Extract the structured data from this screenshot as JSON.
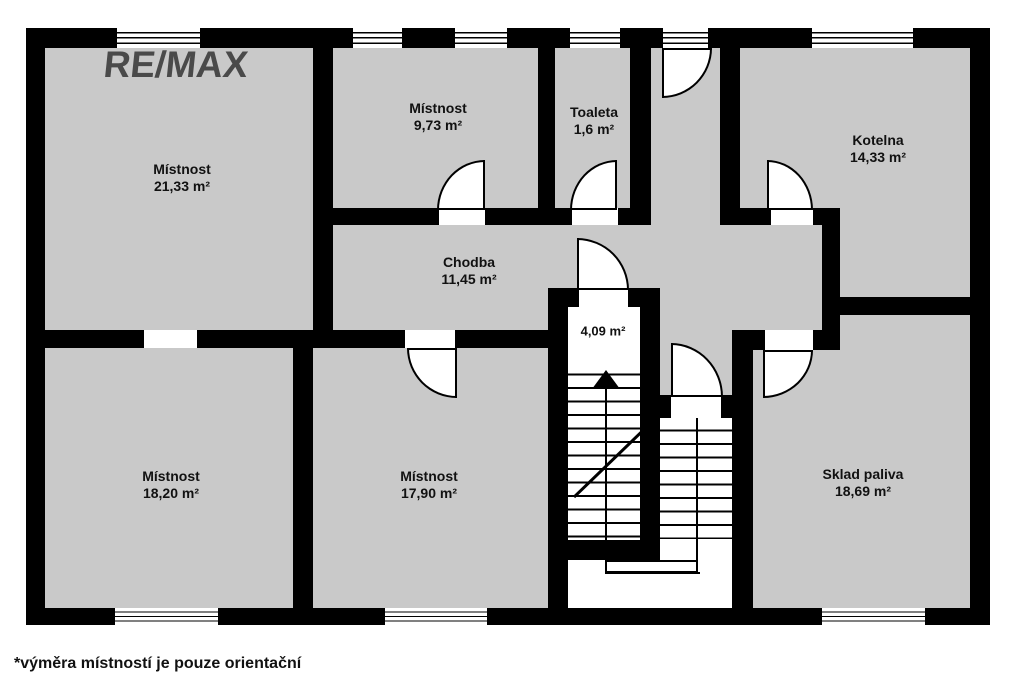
{
  "logo": {
    "text": "RE/MAX"
  },
  "rooms": [
    {
      "name": "Místnost",
      "area": "21,33 m²"
    },
    {
      "name": "Místnost",
      "area": "9,73 m²"
    },
    {
      "name": "Toaleta",
      "area": "1,6 m²"
    },
    {
      "name": "Kotelna",
      "area": "14,33 m²"
    },
    {
      "name": "Chodba",
      "area": "11,45 m²"
    },
    {
      "name": "Místnost",
      "area": "18,20 m²"
    },
    {
      "name": "Místnost",
      "area": "17,90 m²"
    },
    {
      "name": "Sklad paliva",
      "area": "18,69 m²"
    }
  ],
  "staircase": {
    "area": "4,09 m²"
  },
  "footer": {
    "note": "*výměra místností je pouze orientační"
  },
  "colors": {
    "floor": "#c9c9c9",
    "wall": "#000000",
    "logo": "#4a4a4a",
    "background": "#ffffff"
  }
}
